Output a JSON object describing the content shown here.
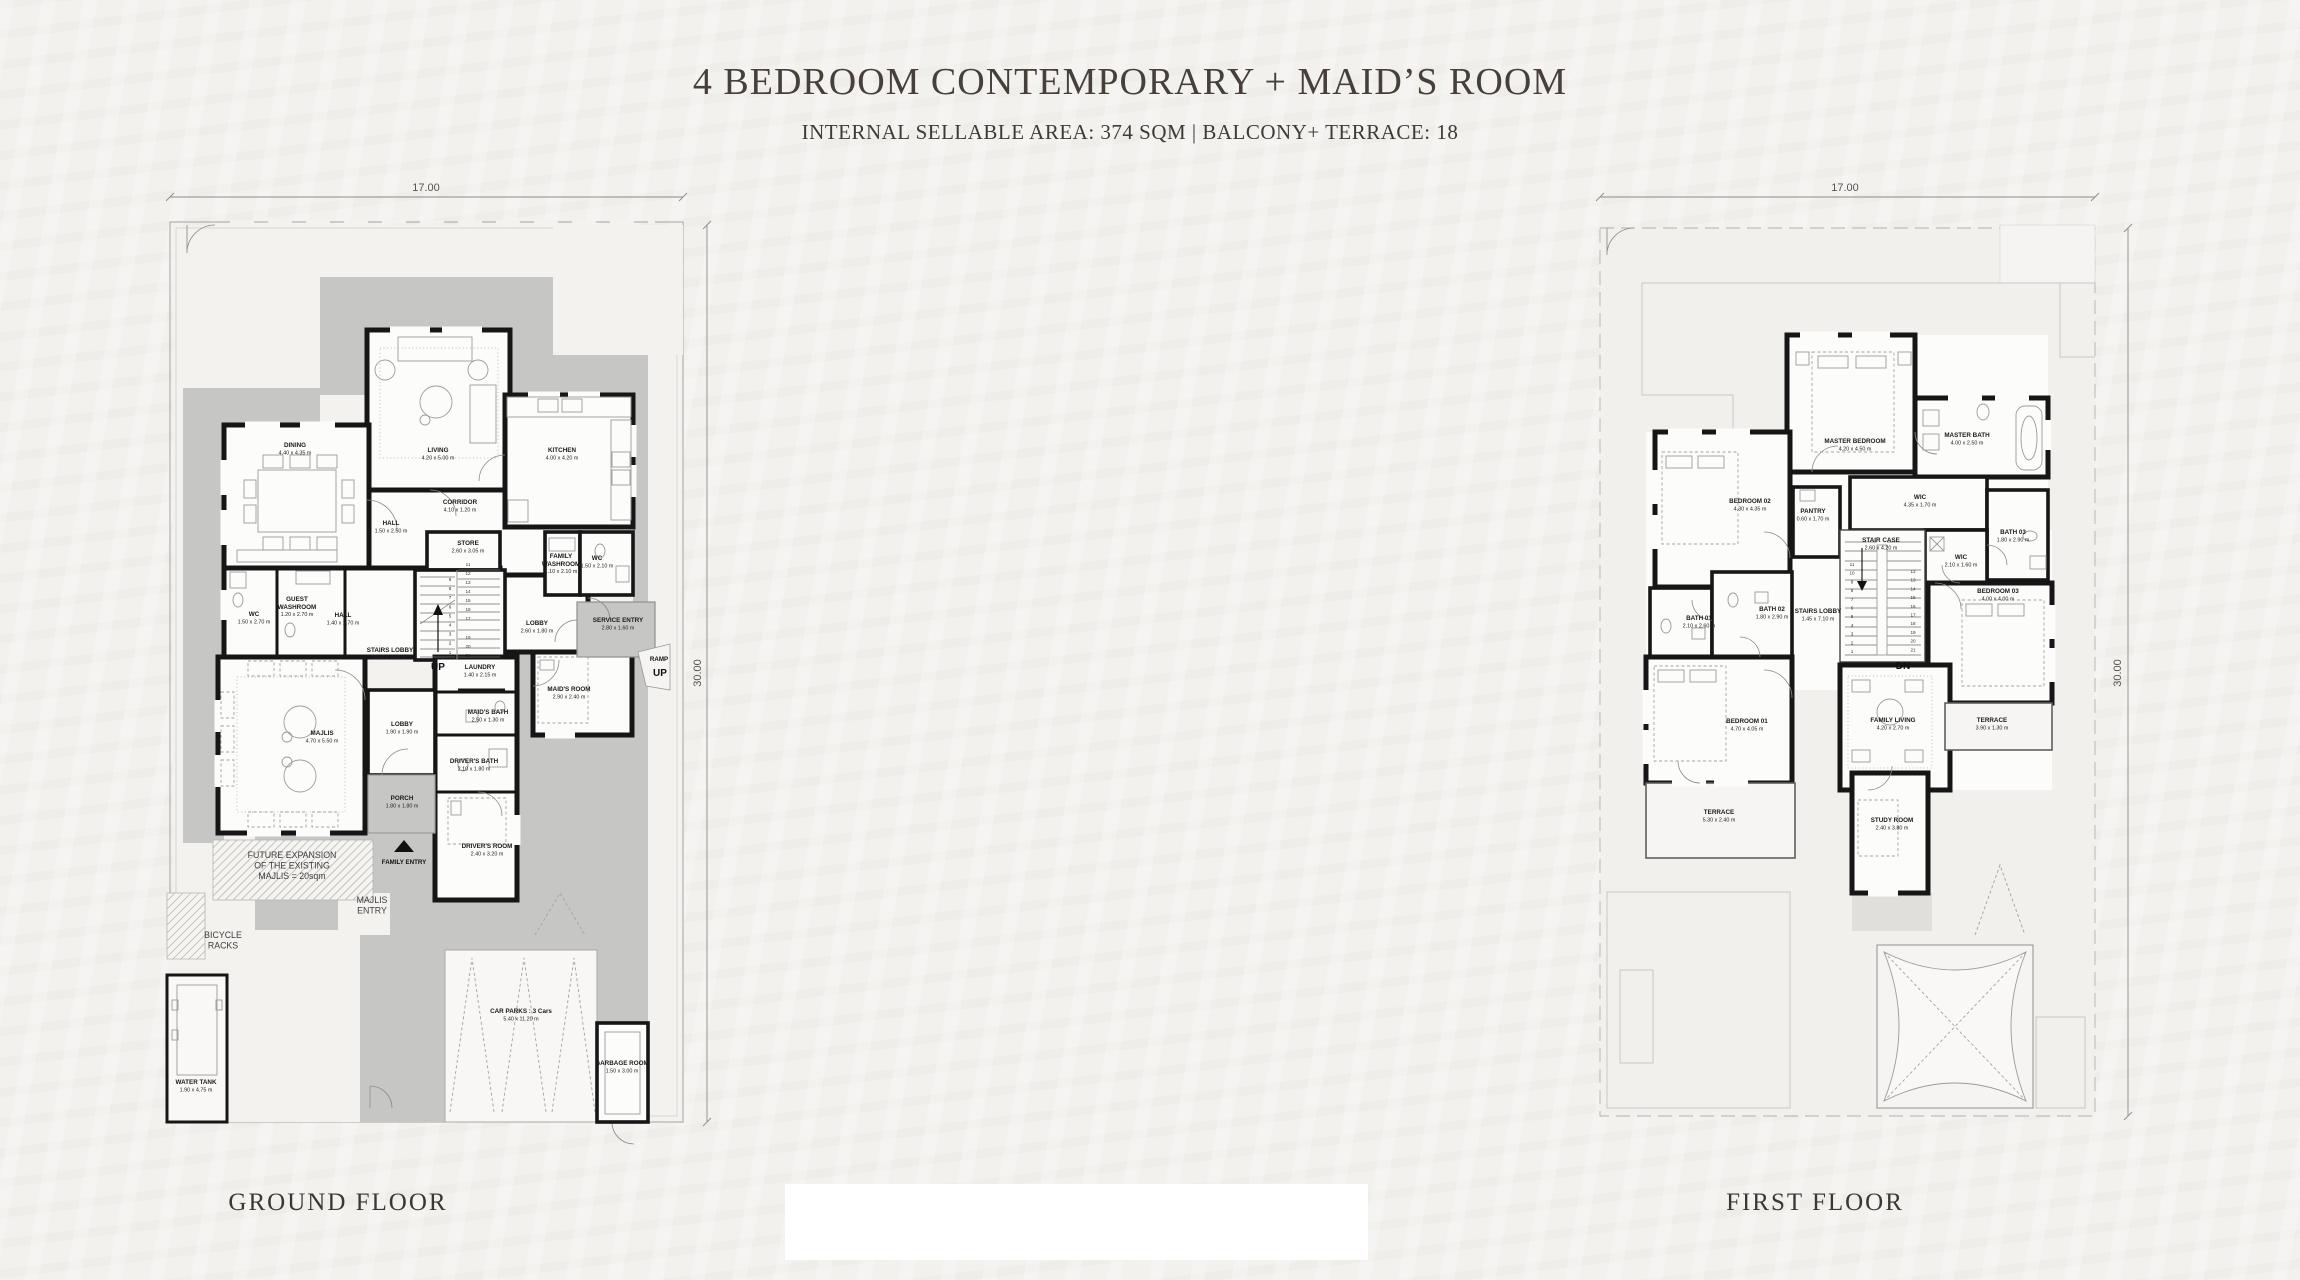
{
  "page": {
    "title": "4 BEDROOM CONTEMPORARY + MAID’S ROOM",
    "subtitle": "INTERNAL SELLABLE AREA: 374 SQM | BALCONY+ TERRACE: 18"
  },
  "colors": {
    "paper": "#f3f1ee",
    "hardscape": "#c6c6c5",
    "wall": "#161616",
    "title_text": "#47403a"
  },
  "ground_floor": {
    "caption": "GROUND FLOOR",
    "plot_width_label": "17.00",
    "plot_height_label": "30.00",
    "labels": [
      {
        "x": 295,
        "y": 447,
        "t": "DINING",
        "s": "4.40 x 4.35 m"
      },
      {
        "x": 438,
        "y": 452,
        "t": "LIVING",
        "s": "4.20 x 5.00 m"
      },
      {
        "x": 460,
        "y": 504,
        "t": "CORRIDOR",
        "s": "4.10 x 1.20 m"
      },
      {
        "x": 391,
        "y": 525,
        "t": "HALL",
        "s": "1.50 x 2.50 m"
      },
      {
        "x": 468,
        "y": 545,
        "t": "STORE",
        "s": "2.60 x 3.05 m"
      },
      {
        "x": 254,
        "y": 616,
        "t": "WC",
        "s": "1.50 x 2.70 m"
      },
      {
        "x": 297,
        "y": 601,
        "t": "GUEST|WASHROOM",
        "s": "1.20 x 2.70 m"
      },
      {
        "x": 343,
        "y": 617,
        "t": "HALL",
        "s": "1.40 x 2.70 m"
      },
      {
        "x": 390,
        "y": 652,
        "t": "STAIRS LOBBY",
        "s": "2.80 x 4.40 m"
      },
      {
        "x": 438,
        "y": 670,
        "t": "UP",
        "c": "up"
      },
      {
        "x": 537,
        "y": 625,
        "t": "LOBBY",
        "s": "2.60 x 1.80 m"
      },
      {
        "x": 562,
        "y": 452,
        "t": "KITCHEN",
        "s": "4.00 x 4.20 m"
      },
      {
        "x": 561,
        "y": 558,
        "t": "FAMILY|WASHROOM",
        "s": "1.10 x 2.10 m"
      },
      {
        "x": 597,
        "y": 560,
        "t": "WC",
        "s": "1.50 x 2.10 m"
      },
      {
        "x": 618,
        "y": 622,
        "t": "SERVICE ENTRY",
        "s": "2.80 x 1.60 m"
      },
      {
        "x": 659,
        "y": 661,
        "t": "RAMP",
        "c": "entry"
      },
      {
        "x": 660,
        "y": 676,
        "t": "UP",
        "c": "up"
      },
      {
        "x": 322,
        "y": 735,
        "t": "MAJLIS",
        "s": "4.70 x 5.50 m"
      },
      {
        "x": 480,
        "y": 669,
        "t": "LAUNDRY",
        "s": "1.40 x 2.15 m"
      },
      {
        "x": 488,
        "y": 714,
        "t": "MAID'S BATH",
        "s": "2.50 x 1.30 m"
      },
      {
        "x": 402,
        "y": 726,
        "t": "LOBBY",
        "s": "1.90 x 1.90 m"
      },
      {
        "x": 474,
        "y": 763,
        "t": "DRIVER'S BATH",
        "s": "2.10 x 1.80 m"
      },
      {
        "x": 402,
        "y": 800,
        "t": "PORCH",
        "s": "1.80 x 1.80 m"
      },
      {
        "x": 404,
        "y": 864,
        "t": "FAMILY ENTRY",
        "c": "entry"
      },
      {
        "x": 487,
        "y": 848,
        "t": "DRIVER'S ROOM",
        "s": "2.40 x 3.20 m"
      },
      {
        "x": 569,
        "y": 691,
        "t": "MAID'S ROOM",
        "s": "2.90 x 2.40 m"
      },
      {
        "x": 292,
        "y": 858,
        "t": "FUTURE EXPANSION|OF THE EXISTING|MAJLIS = 20sqm",
        "c": "note"
      },
      {
        "x": 372,
        "y": 903,
        "t": "MAJLIS|ENTRY",
        "c": "note"
      },
      {
        "x": 223,
        "y": 938,
        "t": "BICYCLE|RACKS",
        "c": "note"
      },
      {
        "x": 196,
        "y": 1084,
        "t": "WATER TANK",
        "s": "1.90 x 4.75 m"
      },
      {
        "x": 521,
        "y": 1013,
        "t": "CAR PARKS : 3 Cars",
        "s": "5.40 x 11.20 m"
      },
      {
        "x": 622,
        "y": 1065,
        "t": "GARBAGE ROOM",
        "s": "1.50 x 3.00 m"
      },
      {
        "x": 426,
        "y": 191,
        "t": "17.00",
        "c": "dim"
      },
      {
        "x": 701,
        "y": 673,
        "t": "30.00",
        "c": "dim",
        "r": -90
      }
    ],
    "stairs": [
      {
        "x": 450,
        "y0": 581,
        "dy": 9.1,
        "v": [
          "9",
          "8",
          "7",
          "6",
          "5",
          "4",
          "3",
          "2",
          "1"
        ]
      },
      {
        "x": 468,
        "y0": 566,
        "dy": 9,
        "v": [
          "11",
          "12",
          "13",
          "14",
          "15",
          "16",
          "17"
        ]
      },
      {
        "x": 468,
        "y0": 639,
        "dy": 9,
        "v": [
          "19",
          "20",
          "21"
        ]
      }
    ]
  },
  "first_floor": {
    "caption": "FIRST FLOOR",
    "plot_width_label": "17.00",
    "plot_height_label": "30.00",
    "labels": [
      {
        "x": 1855,
        "y": 443,
        "t": "MASTER BEDROOM",
        "s": "4.20 x 4.50 m"
      },
      {
        "x": 1967,
        "y": 437,
        "t": "MASTER BATH",
        "s": "4.00 x 2.50 m"
      },
      {
        "x": 1750,
        "y": 503,
        "t": "BEDROOM 02",
        "s": "4.30 x 4.35 m"
      },
      {
        "x": 1813,
        "y": 513,
        "t": "PANTRY",
        "s": "0.60 x 1.70 m"
      },
      {
        "x": 1920,
        "y": 499,
        "t": "WIC",
        "s": "4.35 x 1.70 m"
      },
      {
        "x": 1881,
        "y": 542,
        "t": "STAIR CASE",
        "s": "2.60 x 4.20 m"
      },
      {
        "x": 1961,
        "y": 559,
        "t": "WIC",
        "s": "2.10 x 1.60 m"
      },
      {
        "x": 2013,
        "y": 534,
        "t": "BATH 03",
        "s": "1.80 x 2.90 m"
      },
      {
        "x": 1998,
        "y": 593,
        "t": "BEDROOM 03",
        "s": "4.00 x 4.00 m"
      },
      {
        "x": 1699,
        "y": 620,
        "t": "BATH 01",
        "s": "2.10 x 2.60 m"
      },
      {
        "x": 1772,
        "y": 611,
        "t": "BATH 02",
        "s": "1.80 x 2.90 m"
      },
      {
        "x": 1818,
        "y": 613,
        "t": "STAIRS LOBBY",
        "s": "1.45 x 7.10 m"
      },
      {
        "x": 1903,
        "y": 669,
        "t": "DN",
        "c": "up"
      },
      {
        "x": 1747,
        "y": 723,
        "t": "BEDROOM 01",
        "s": "4.70 x 4.05 m"
      },
      {
        "x": 1893,
        "y": 722,
        "t": "FAMILY LIVING",
        "s": "4.20 x 2.70 m"
      },
      {
        "x": 1992,
        "y": 722,
        "t": "TERRACE",
        "s": "3.90 x 1.30 m"
      },
      {
        "x": 1719,
        "y": 814,
        "t": "TERRACE",
        "s": "5.30 x 2.40 m"
      },
      {
        "x": 1892,
        "y": 822,
        "t": "STUDY ROOM",
        "s": "2.40 x 3.80 m"
      },
      {
        "x": 1845,
        "y": 191,
        "t": "17.00",
        "c": "dim"
      },
      {
        "x": 2121,
        "y": 673,
        "t": "30.00",
        "c": "dim",
        "r": -90
      }
    ],
    "stairs": [
      {
        "x": 1852,
        "y0": 566,
        "dy": 8.7,
        "v": [
          "11",
          "10",
          "9",
          "8",
          "7",
          "6",
          "5",
          "4",
          "3",
          "2",
          "1"
        ]
      },
      {
        "x": 1913,
        "y0": 573,
        "dy": 8.7,
        "v": [
          "12",
          "13",
          "14",
          "15",
          "16",
          "17",
          "18",
          "19",
          "20",
          "21"
        ]
      }
    ]
  }
}
